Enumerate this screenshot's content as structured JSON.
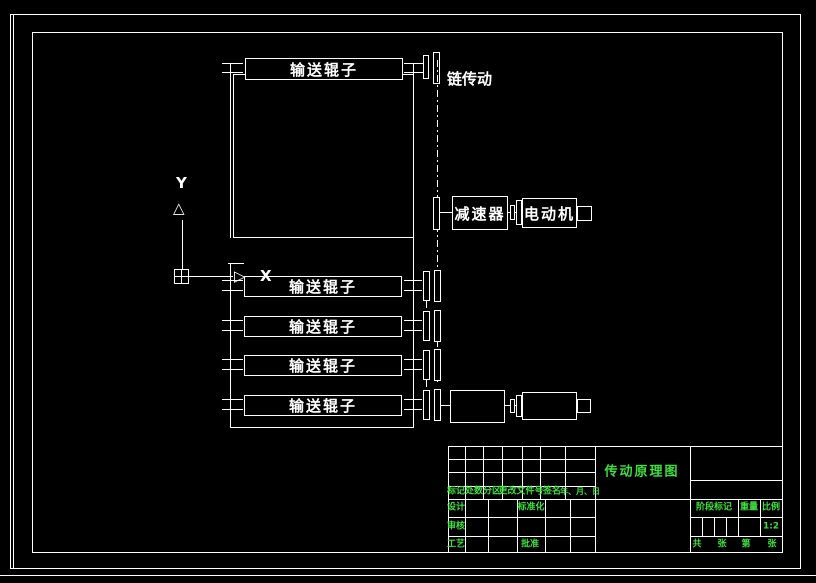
{
  "colors": {
    "background": "#000000",
    "line": "#ffffff",
    "text_green": "#3fdf3f",
    "text_white": "#ffffff"
  },
  "drawing": {
    "top_conveyor_roller_label": "输送辊子",
    "chain_drive_label": "链传动",
    "reducer_label": "减速器",
    "motor_label": "电动机",
    "rollers": [
      "输送辊子",
      "输送辊子",
      "输送辊子",
      "输送辊子"
    ],
    "ucs": {
      "y_label": "Y",
      "x_label": "X",
      "up_arrow": "△",
      "right_arrow": "▷"
    }
  },
  "title_block": {
    "drawing_title": "传动原理图",
    "revision_headers": [
      "标记",
      "处数",
      "分区",
      "更改文件号",
      "签名",
      "年、月、日"
    ],
    "design_label": "设计",
    "standardization_label": "标准化",
    "audit_label": "审核",
    "process_label": "工艺",
    "approve_label": "批准",
    "stage_mark_label": "阶段标记",
    "weight_label": "重量",
    "scale_label": "比例",
    "scale_value": "1:2",
    "sheet_total_label": "共",
    "sheet_unit_a": "张",
    "sheet_page_label": "第",
    "sheet_unit_b": "张"
  }
}
